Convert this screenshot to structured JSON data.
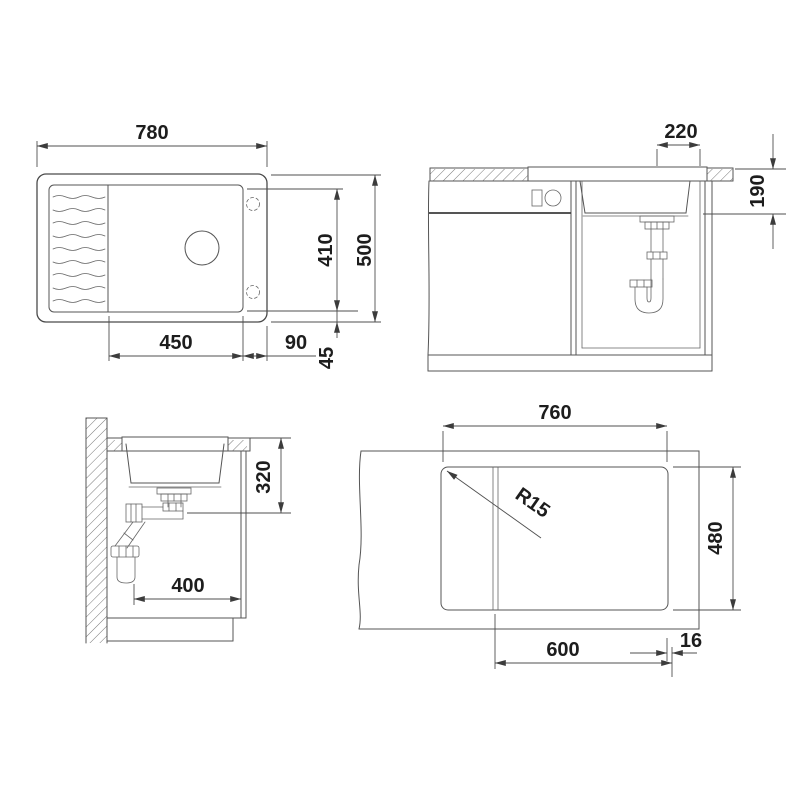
{
  "drawing": {
    "plan": {
      "overall_width": "780",
      "bowl_length": "450",
      "bowl_to_right_edge": "90",
      "bowl_to_front_edge": "45",
      "bowl_width": "410",
      "overall_depth": "500"
    },
    "front": {
      "drain_to_edge": "220",
      "bowl_depth": "190"
    },
    "side": {
      "outlet_height": "320",
      "wall_clearance": "400"
    },
    "cutout": {
      "cutout_width": "760",
      "cutout_depth": "480",
      "corner_radius": "R15",
      "min_cabinet_width": "600",
      "edge_offset": "16"
    }
  }
}
